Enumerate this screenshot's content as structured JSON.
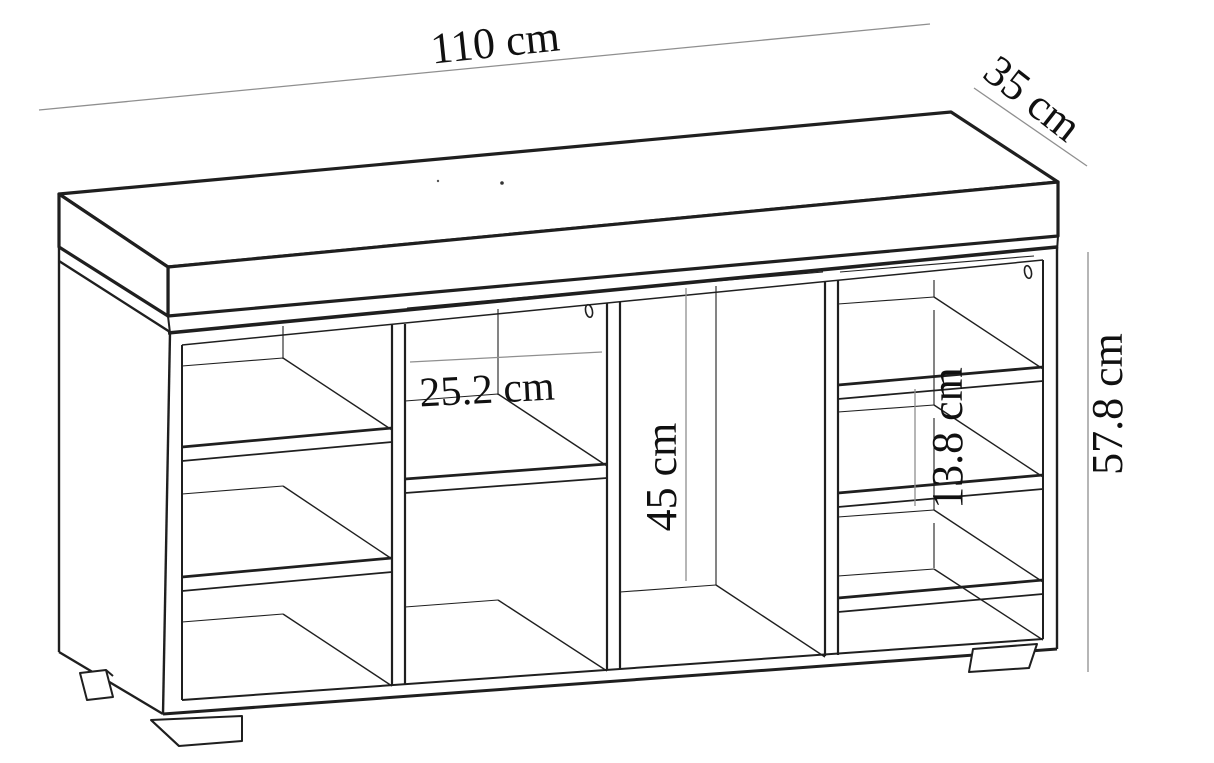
{
  "diagram": {
    "kind": "furniture dimensional line drawing",
    "subject": "shoe storage bench with seat cushion, open cubby shelves and feet",
    "background": "#ffffff",
    "colors": {
      "line": "#1f1f1f",
      "dimension_line": "#8f8f8f",
      "text": "#101010"
    },
    "dimensions": {
      "overall_width": "110 cm",
      "overall_depth": "35 cm",
      "overall_height": "57.8 cm",
      "compartment_width": "25.2 cm",
      "tall_compartment_height": "45 cm",
      "shelf_spacing": "13.8 cm"
    }
  }
}
